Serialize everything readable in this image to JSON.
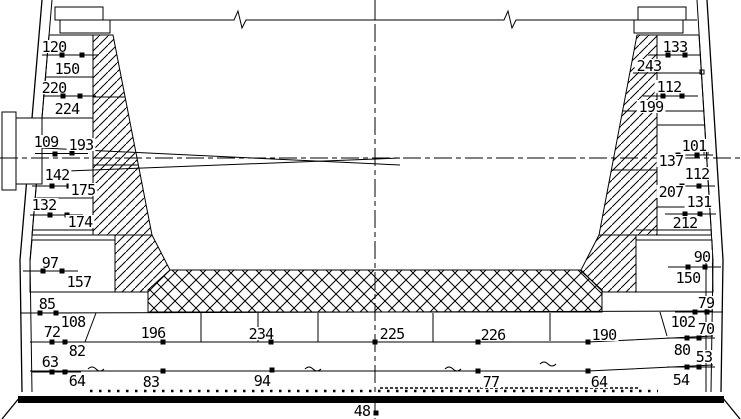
{
  "colors": {
    "ink": "#000000",
    "paper": "#ffffff"
  },
  "measurements": {
    "left_wall": [
      {
        "value": "120",
        "x": 54,
        "y": 52,
        "dots": [
          [
            62,
            55
          ],
          [
            82,
            55
          ]
        ]
      },
      {
        "value": "150",
        "x": 67,
        "y": 74,
        "dots": []
      },
      {
        "value": "220",
        "x": 54,
        "y": 93,
        "dots": [
          [
            63,
            96
          ],
          [
            80,
            96
          ]
        ]
      },
      {
        "value": "224",
        "x": 67,
        "y": 114,
        "dots": []
      },
      {
        "value": "109",
        "x": 46,
        "y": 147,
        "dots": [
          [
            55,
            154
          ],
          [
            72,
            153
          ]
        ]
      },
      {
        "value": "193",
        "x": 81,
        "y": 150,
        "dots": []
      },
      {
        "value": "142",
        "x": 57,
        "y": 180,
        "dots": [
          [
            52,
            186
          ],
          [
            69,
            186
          ]
        ]
      },
      {
        "value": "175",
        "x": 83,
        "y": 195,
        "dots": []
      },
      {
        "value": "132",
        "x": 44,
        "y": 210,
        "dots": [
          [
            50,
            215
          ],
          [
            67,
            215
          ]
        ]
      },
      {
        "value": "174",
        "x": 80,
        "y": 227,
        "dots": []
      },
      {
        "value": "97",
        "x": 50,
        "y": 268,
        "dots": [
          [
            43,
            271
          ],
          [
            62,
            271
          ]
        ]
      },
      {
        "value": "157",
        "x": 79,
        "y": 287,
        "dots": []
      },
      {
        "value": "85",
        "x": 47,
        "y": 309,
        "dots": [
          [
            40,
            313
          ],
          [
            56,
            313
          ]
        ]
      },
      {
        "value": "108",
        "x": 73,
        "y": 327,
        "dots": []
      },
      {
        "value": "72",
        "x": 52,
        "y": 337,
        "dots": [
          [
            52,
            342
          ],
          [
            65,
            342
          ]
        ]
      },
      {
        "value": "82",
        "x": 77,
        "y": 356,
        "dots": []
      },
      {
        "value": "63",
        "x": 50,
        "y": 367,
        "dots": [
          [
            52,
            372
          ],
          [
            65,
            372
          ]
        ]
      },
      {
        "value": "64",
        "x": 77,
        "y": 386,
        "dots": []
      }
    ],
    "right_wall": [
      {
        "value": "133",
        "x": 675,
        "y": 52,
        "dots": [
          [
            668,
            55
          ],
          [
            685,
            55
          ]
        ]
      },
      {
        "value": "243",
        "x": 649,
        "y": 71,
        "dots": []
      },
      {
        "value": "112",
        "x": 669,
        "y": 92,
        "dots": [
          [
            663,
            96
          ],
          [
            682,
            96
          ]
        ]
      },
      {
        "value": "199",
        "x": 651,
        "y": 112,
        "dots": []
      },
      {
        "value": "101",
        "x": 694,
        "y": 151,
        "dots": [
          [
            678,
            155
          ],
          [
            697,
            155
          ]
        ]
      },
      {
        "value": "137",
        "x": 671,
        "y": 166,
        "dots": []
      },
      {
        "value": "112",
        "x": 697,
        "y": 179,
        "dots": [
          [
            682,
            186
          ],
          [
            699,
            186
          ]
        ]
      },
      {
        "value": "207",
        "x": 671,
        "y": 197,
        "dots": []
      },
      {
        "value": "131",
        "x": 699,
        "y": 207,
        "dots": [
          [
            685,
            214
          ],
          [
            700,
            214
          ]
        ]
      },
      {
        "value": "212",
        "x": 685,
        "y": 228,
        "dots": []
      },
      {
        "value": "90",
        "x": 702,
        "y": 262,
        "dots": [
          [
            688,
            267
          ],
          [
            705,
            267
          ]
        ]
      },
      {
        "value": "150",
        "x": 688,
        "y": 283,
        "dots": []
      },
      {
        "value": "79",
        "x": 706,
        "y": 308,
        "dots": [
          [
            695,
            312
          ],
          [
            707,
            312
          ]
        ]
      },
      {
        "value": "102",
        "x": 683,
        "y": 327,
        "dots": []
      },
      {
        "value": "70",
        "x": 706,
        "y": 334,
        "dots": [
          [
            687,
            338
          ],
          [
            699,
            338
          ]
        ]
      },
      {
        "value": "80",
        "x": 682,
        "y": 355,
        "dots": []
      },
      {
        "value": "53",
        "x": 704,
        "y": 362,
        "dots": [
          [
            687,
            367
          ],
          [
            699,
            367
          ]
        ]
      },
      {
        "value": "54",
        "x": 681,
        "y": 385,
        "dots": []
      }
    ],
    "bottom": [
      {
        "value": "196",
        "x": 153,
        "y": 338,
        "dots": [
          [
            163,
            342
          ]
        ]
      },
      {
        "value": "234",
        "x": 261,
        "y": 339,
        "dots": [
          [
            271,
            342
          ]
        ]
      },
      {
        "value": "225",
        "x": 392,
        "y": 339,
        "dots": [
          [
            375,
            342
          ]
        ]
      },
      {
        "value": "226",
        "x": 493,
        "y": 340,
        "dots": [
          [
            478,
            342
          ]
        ]
      },
      {
        "value": "190",
        "x": 604,
        "y": 340,
        "dots": [
          [
            588,
            342
          ]
        ]
      },
      {
        "value": "83",
        "x": 151,
        "y": 387,
        "dots": [
          [
            163,
            371
          ]
        ]
      },
      {
        "value": "94",
        "x": 262,
        "y": 386,
        "dots": [
          [
            272,
            370
          ]
        ]
      },
      {
        "value": "77",
        "x": 491,
        "y": 387,
        "dots": [
          [
            478,
            371
          ]
        ]
      },
      {
        "value": "64",
        "x": 599,
        "y": 387,
        "dots": [
          [
            588,
            371
          ]
        ]
      },
      {
        "value": "48",
        "x": 362,
        "y": 416,
        "dots": [
          [
            376,
            413
          ]
        ]
      }
    ]
  }
}
